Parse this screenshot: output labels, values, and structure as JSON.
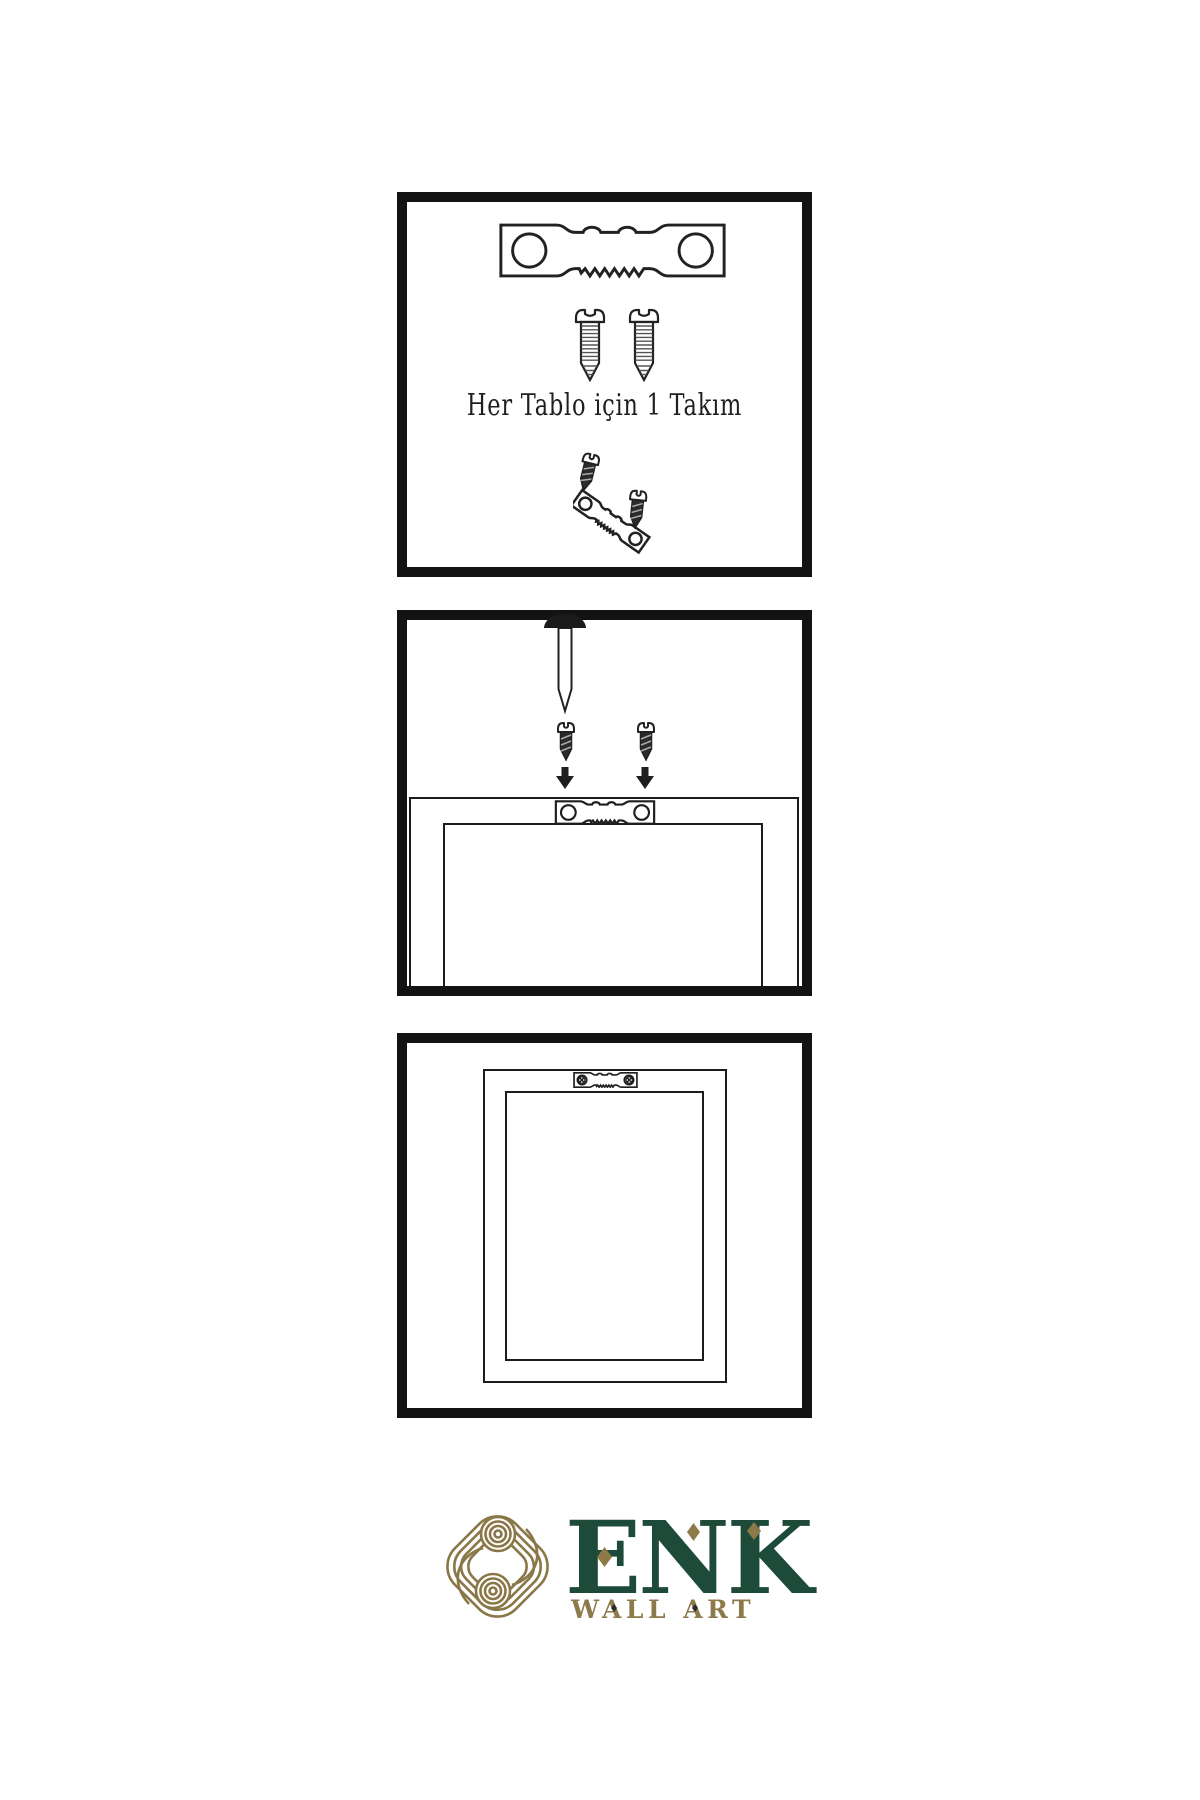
{
  "colors": {
    "background": "#ffffff",
    "panel_border": "#131313",
    "line_art": "#222222",
    "dark_metal": "#262626",
    "brand_green": "#1d4a39",
    "brand_gold": "#8a7748"
  },
  "panel_kit": {
    "caption": "Her Tablo için 1 Takım",
    "icons": [
      "sawtooth-hanger-icon",
      "screw-icon",
      "screw-icon",
      "screw-into-tilted-hanger-icon"
    ]
  },
  "panel_mount": {
    "icons": [
      "wall-nail-icon",
      "dark-screw-icon",
      "dark-screw-icon",
      "down-arrow-icon",
      "down-arrow-icon",
      "frame-back-outline-icon",
      "sawtooth-hanger-icon"
    ]
  },
  "panel_hang": {
    "icons": [
      "frame-back-outline-icon",
      "mounted-sawtooth-hanger-icon"
    ]
  },
  "logo": {
    "brand": "ENK",
    "subtitle": "WALL ART",
    "mark": "interlaced-knot-icon"
  }
}
